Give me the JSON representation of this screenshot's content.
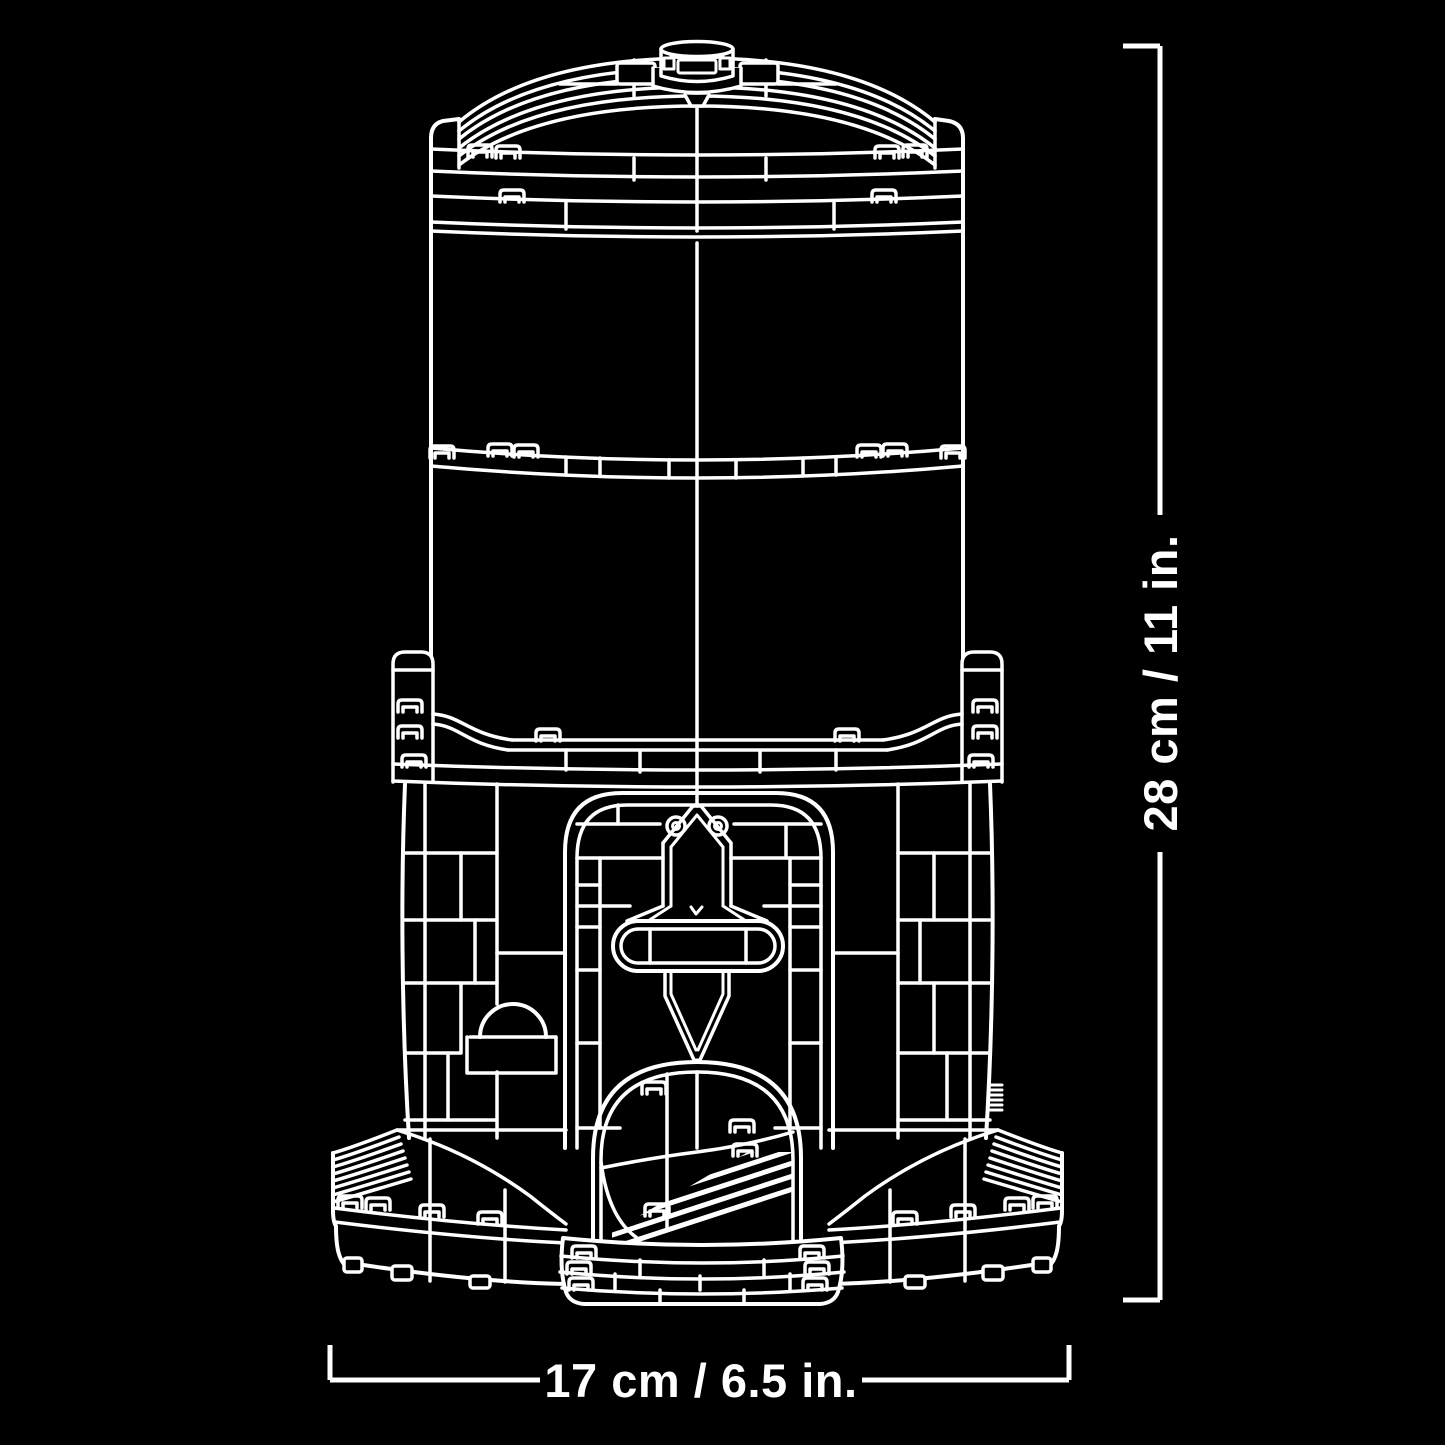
{
  "page": {
    "background": "#000000",
    "line_color": "#ffffff"
  },
  "figure": {
    "subject": "brick-built tower line art with domed cap, arched doorway and oval base"
  },
  "dimension_annotations": {
    "height": {
      "label": "28 cm / 11 in."
    },
    "width": {
      "label": "17 cm / 6.5 in."
    }
  }
}
